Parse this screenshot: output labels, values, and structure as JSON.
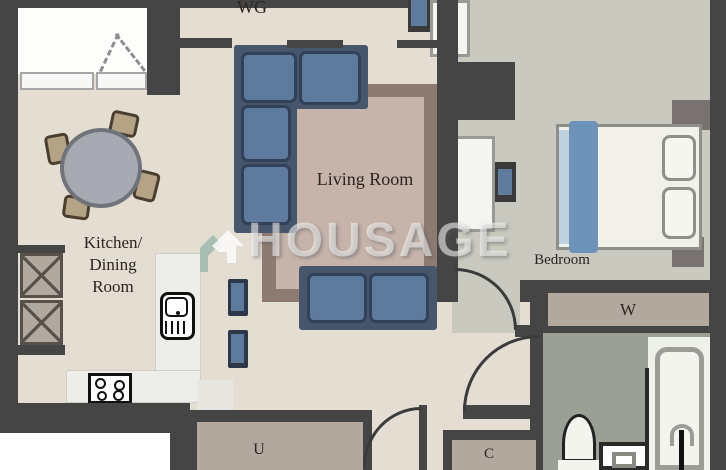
{
  "brand": {
    "watermark_text": "HOUSAGE"
  },
  "rooms": {
    "wg": {
      "label": "WG"
    },
    "living_room": {
      "label": "Living Room"
    },
    "kitchen": {
      "label_line1": "Kitchen/",
      "label_line2": "Dining",
      "label_line3": "Room"
    },
    "bedroom": {
      "label": "Bedroom"
    },
    "wardrobe": {
      "label": "W"
    },
    "utility": {
      "label": "U"
    },
    "closet": {
      "label": "C"
    }
  },
  "colors": {
    "wall": "#454545",
    "floorMain": "#e4ddd2",
    "floorBedroom": "#c9c9bf",
    "floorBath": "#9aa095",
    "floorStorage": "#b3a89d",
    "rugBorder": "#8d7b72",
    "rugInner": "#c6b3aa",
    "sofaFrame": "#47566a",
    "sofaCushion": "#5e7a9c",
    "sofaEdge": "#31415a",
    "accentBlue": "#6d94b8",
    "chairTan": "#b5a386",
    "tableGray": "#a7aab2",
    "logoTeal": "#9db9ae"
  }
}
